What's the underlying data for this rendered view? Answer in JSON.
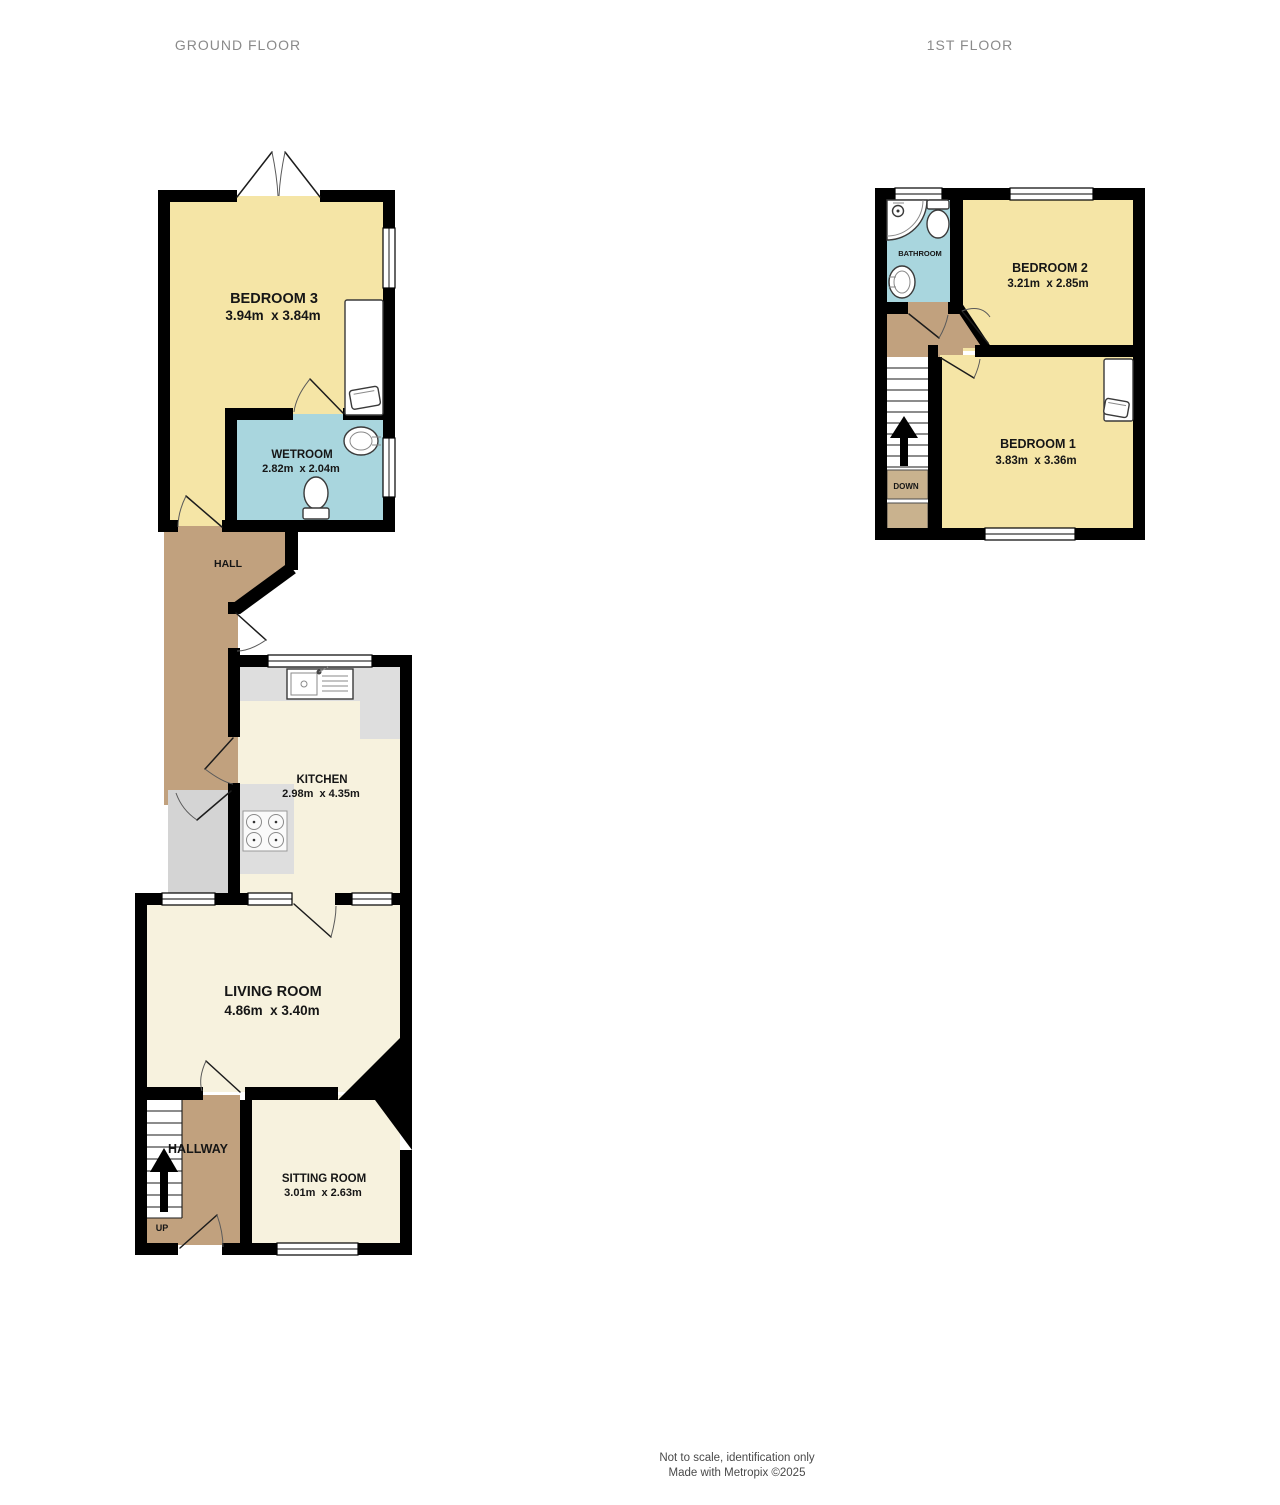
{
  "floors": {
    "ground": {
      "title": "GROUND FLOOR",
      "rooms": {
        "bedroom3": {
          "name": "BEDROOM 3",
          "dims": "3.94m  x 3.84m"
        },
        "wetroom": {
          "name": "WETROOM",
          "dims": "2.82m  x 2.04m"
        },
        "hall": {
          "name": "HALL"
        },
        "kitchen": {
          "name": "KITCHEN",
          "dims": "2.98m  x 4.35m"
        },
        "living_room": {
          "name": "LIVING ROOM",
          "dims": "4.86m  x 3.40m"
        },
        "hallway": {
          "name": "HALLWAY"
        },
        "sitting_room": {
          "name": "SITTING ROOM",
          "dims": "3.01m  x 2.63m"
        }
      },
      "stairs": {
        "direction_label": "UP"
      }
    },
    "first": {
      "title": "1ST FLOOR",
      "rooms": {
        "bathroom": {
          "name": "BATHROOM"
        },
        "bedroom2": {
          "name": "BEDROOM 2",
          "dims": "3.21m  x 2.85m"
        },
        "bedroom1": {
          "name": "BEDROOM 1",
          "dims": "3.83m  x 3.36m"
        }
      },
      "stairs": {
        "direction_label": "DOWN"
      }
    }
  },
  "footer": {
    "line1": "Not to scale, identification only",
    "line2": "Made with Metropix ©2025"
  },
  "colors": {
    "wall": "#000000",
    "bedroom_fill": "#f5e5a6",
    "cream_fill": "#f7f2de",
    "wet_fill": "#a9d6de",
    "hall_fill": "#c1a17e",
    "stair_block_fill": "#c9b28e",
    "counter_fill": "#dedede",
    "store_fill": "#d4d4d4",
    "floor_title_text": "#8a8a8a",
    "room_label_text": "#161616",
    "footer_text": "#4a4a4a"
  }
}
